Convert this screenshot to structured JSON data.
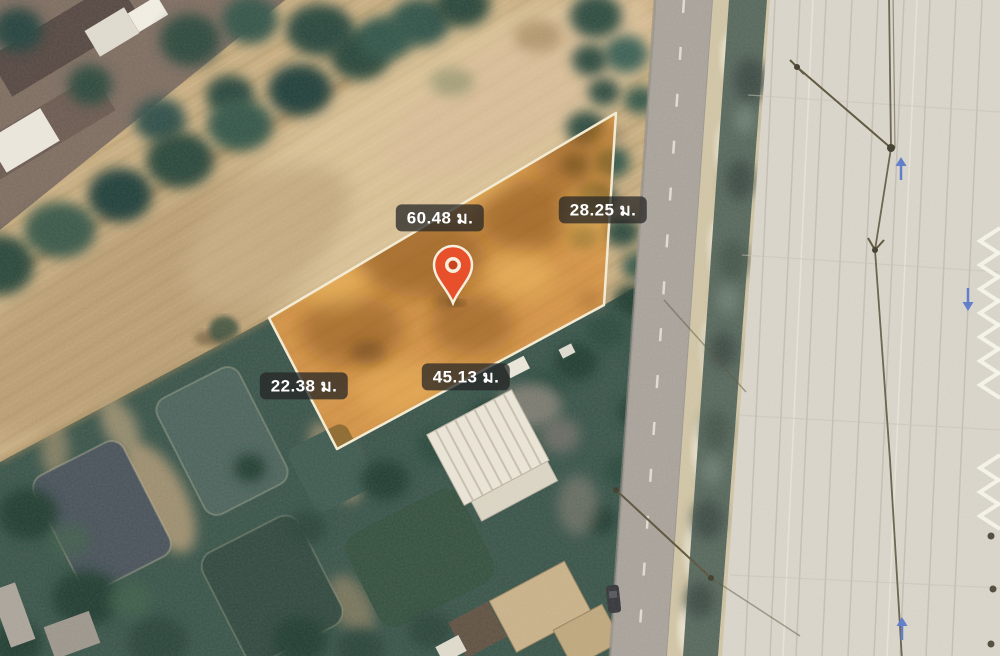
{
  "map": {
    "view": "satellite",
    "unit": "ม.",
    "measurements": [
      {
        "side": "top-left-edge",
        "text": "60.48 ม."
      },
      {
        "side": "top-right-edge",
        "text": "28.25 ม."
      },
      {
        "side": "bottom-left-edge",
        "text": "22.38 ม."
      },
      {
        "side": "bottom-right-edge",
        "text": "45.13 ม."
      }
    ],
    "plot": {
      "polygon_points": "269,318 616,113 604,305 337,449",
      "fill_color": "rgba(222,126,22,0.5)",
      "stroke_color": "#F4EBD3"
    },
    "pin": {
      "color": "#E8502B",
      "inner_ring": "#F6EEDC",
      "anchor_x": 453,
      "anchor_y": 302
    },
    "blue_arrows": [
      {
        "direction": "up"
      },
      {
        "direction": "down"
      },
      {
        "direction": "up"
      }
    ],
    "colors": {
      "field": "#C7AC80",
      "trees": "#2C473A",
      "road": "#A7A199",
      "concrete_yard": "#D7D3C9",
      "pond": "#49525A",
      "canal": "#57675C",
      "label_bg": "rgba(38,38,38,0.75)",
      "label_text": "#FFFFFF",
      "arrow_blue": "#5B79C9"
    }
  }
}
